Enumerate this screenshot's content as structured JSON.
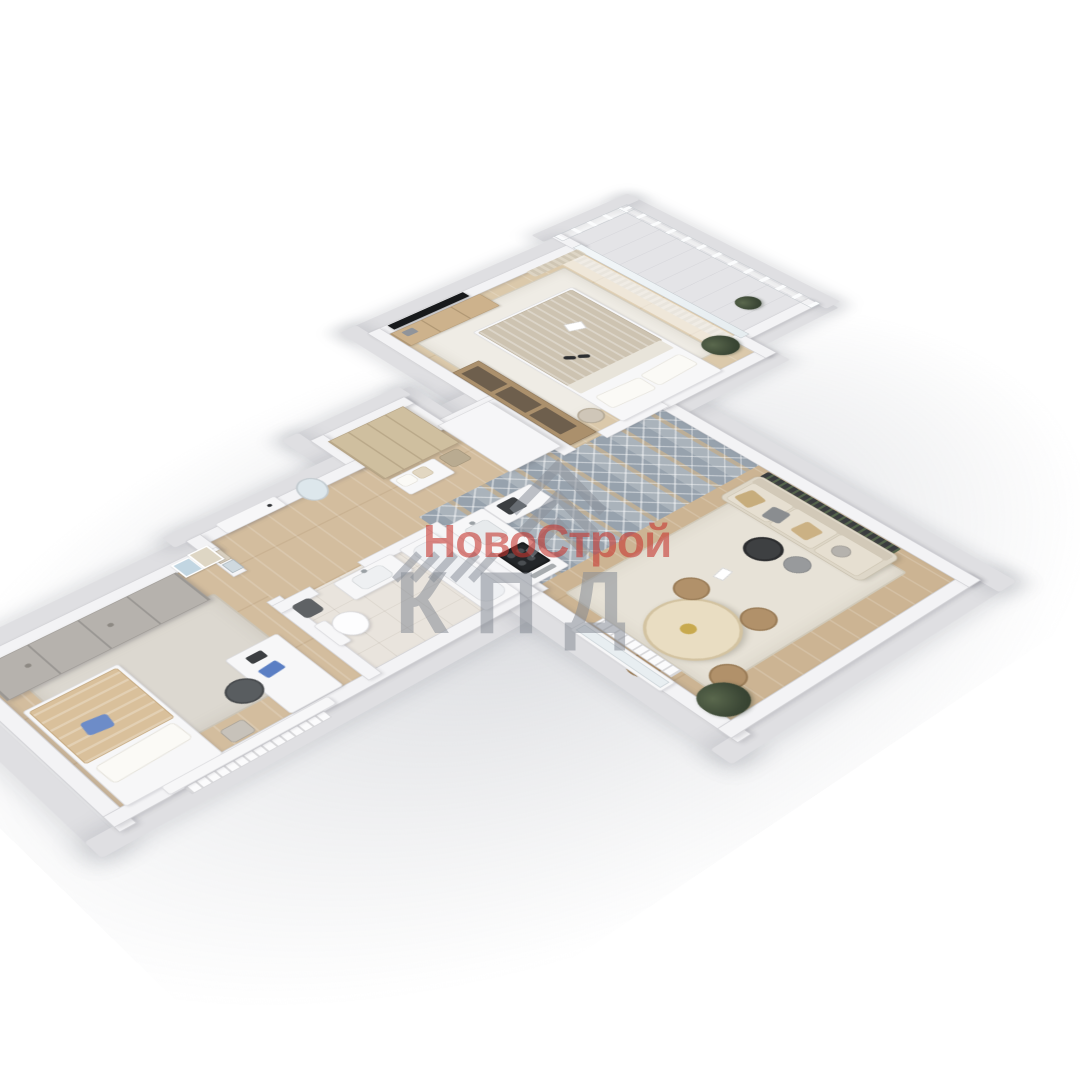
{
  "watermark": {
    "title": "НовоСтрой",
    "subtitle": "КПД",
    "title_color": "#c6372f",
    "subtitle_color": "#878d95",
    "logo": "roof-chevron-stripes"
  },
  "scene": {
    "type": "3d-floorplan-render",
    "view": "isometric top-down cutaway",
    "rooms": [
      "entry-hall",
      "wardrobe-nook",
      "kids-bedroom",
      "bathroom",
      "kitchen",
      "living-dining-room",
      "master-bedroom",
      "balcony"
    ],
    "palette": {
      "background": "#ffffff",
      "walls_cut": "#f3f3f5",
      "outer_plinth": "#dfdfe2",
      "wood_floor": "#d3bd9e",
      "herringbone_tile": "#9aa5b0",
      "bath_tile": "#e9e4dd",
      "rug": "#e7e2d7",
      "furniture_wood": "#cdb28c",
      "tv_black": "#17191b",
      "plant_green": "#3c4836",
      "accent_blue": "#5b7fc4"
    }
  }
}
